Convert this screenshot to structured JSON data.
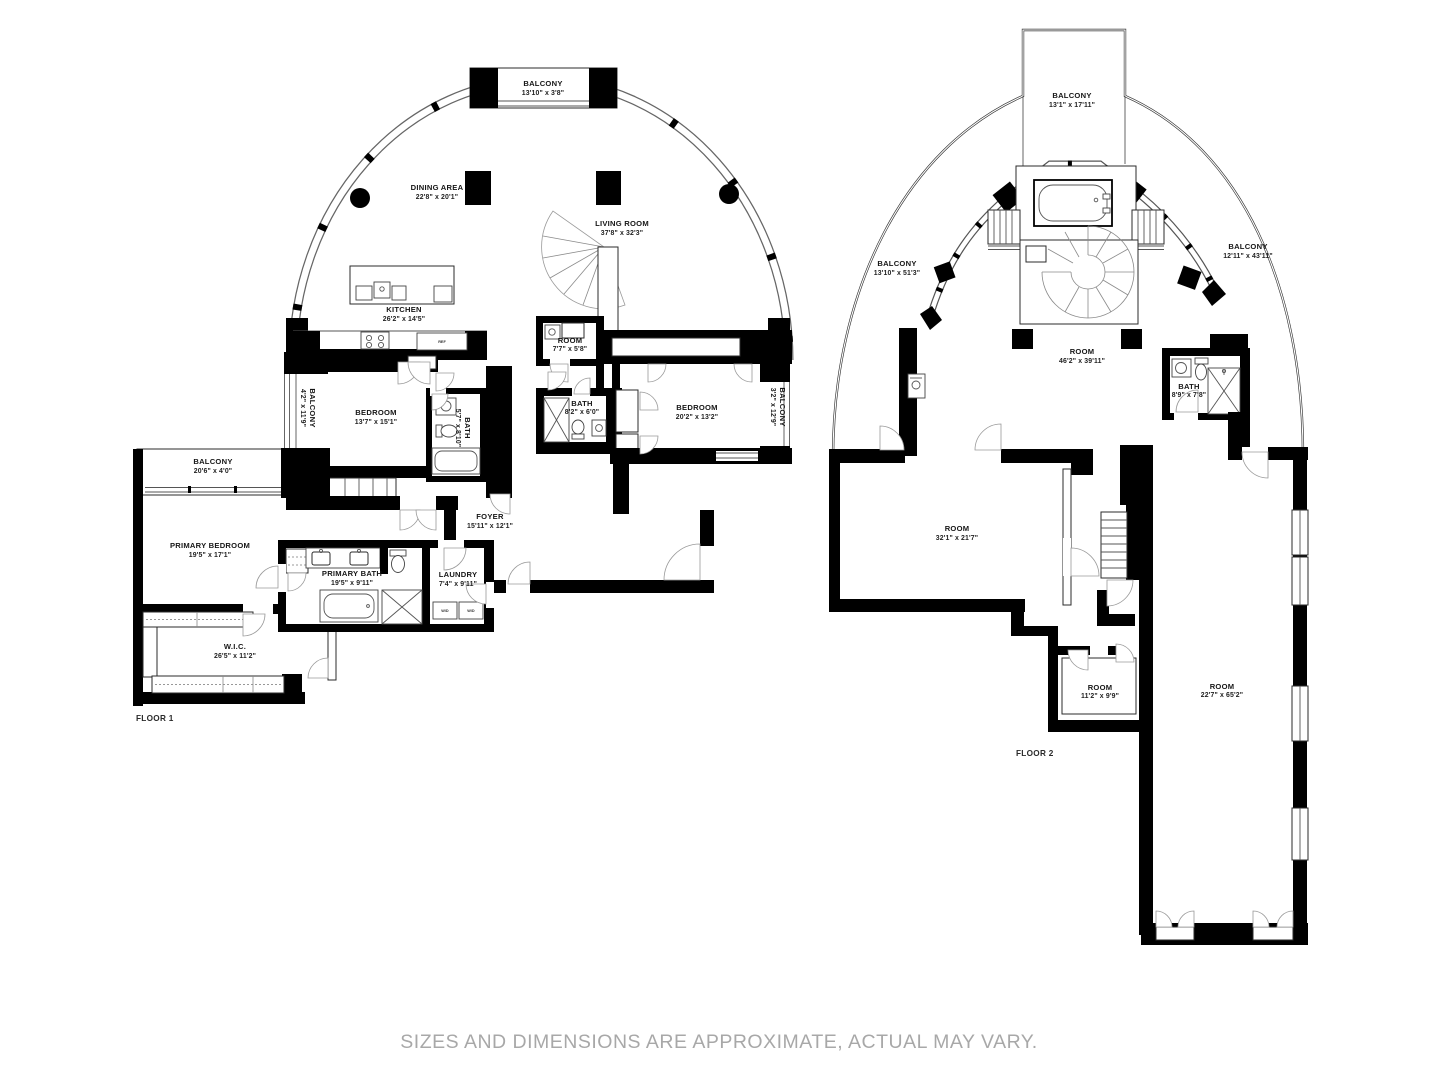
{
  "footer": {
    "disclaimer": "SIZES AND DIMENSIONS ARE APPROXIMATE, ACTUAL MAY VARY."
  },
  "floor1": {
    "label": "FLOOR 1",
    "rooms": {
      "balcony_top": {
        "name": "BALCONY",
        "dims": "13'10\" x 3'8\""
      },
      "dining_area": {
        "name": "DINING AREA",
        "dims": "22'8\" x 20'1\""
      },
      "living_room": {
        "name": "LIVING ROOM",
        "dims": "37'8\" x 32'3\""
      },
      "kitchen": {
        "name": "KITCHEN",
        "dims": "26'2\" x 14'5\""
      },
      "small_room": {
        "name": "ROOM",
        "dims": "7'7\" x 5'8\""
      },
      "balcony_left": {
        "name": "BALCONY",
        "dims": "4'2\" x 11'9\""
      },
      "bedroom_1": {
        "name": "BEDROOM",
        "dims": "13'7\" x 15'1\""
      },
      "bath_1": {
        "name": "BATH",
        "dims": "5'7\" x 8'10\""
      },
      "bath_2": {
        "name": "BATH",
        "dims": "8'2\" x 6'0\""
      },
      "bedroom_2": {
        "name": "BEDROOM",
        "dims": "20'2\" x 13'2\""
      },
      "balcony_right": {
        "name": "BALCONY",
        "dims": "3'2\" x 12'9\""
      },
      "balcony_west": {
        "name": "BALCONY",
        "dims": "20'6\" x 4'0\""
      },
      "foyer": {
        "name": "FOYER",
        "dims": "15'11\" x 12'1\""
      },
      "primary_bedroom": {
        "name": "PRIMARY BEDROOM",
        "dims": "19'5\" x 17'1\""
      },
      "primary_bath": {
        "name": "PRIMARY BATH",
        "dims": "19'5\" x 9'11\""
      },
      "laundry": {
        "name": "LAUNDRY",
        "dims": "7'4\" x 9'11\""
      },
      "wic": {
        "name": "W.I.C.",
        "dims": "26'5\" x 11'2\""
      }
    },
    "appliances": {
      "refrigerator": "REF",
      "washer": "W/D",
      "dryer": "W/D"
    }
  },
  "floor2": {
    "label": "FLOOR 2",
    "rooms": {
      "balcony_top": {
        "name": "BALCONY",
        "dims": "13'1\" x 17'11\""
      },
      "balcony_left": {
        "name": "BALCONY",
        "dims": "13'10\" x 51'3\""
      },
      "balcony_right": {
        "name": "BALCONY",
        "dims": "12'11\" x 43'11\""
      },
      "main_room": {
        "name": "ROOM",
        "dims": "46'2\" x 39'11\""
      },
      "bath": {
        "name": "BATH",
        "dims": "8'9\" x 7'8\""
      },
      "room_sw": {
        "name": "ROOM",
        "dims": "32'1\" x 21'7\""
      },
      "room_small": {
        "name": "ROOM",
        "dims": "11'2\" x 9'9\""
      },
      "room_tall": {
        "name": "ROOM",
        "dims": "22'7\" x 65'2\""
      }
    }
  }
}
